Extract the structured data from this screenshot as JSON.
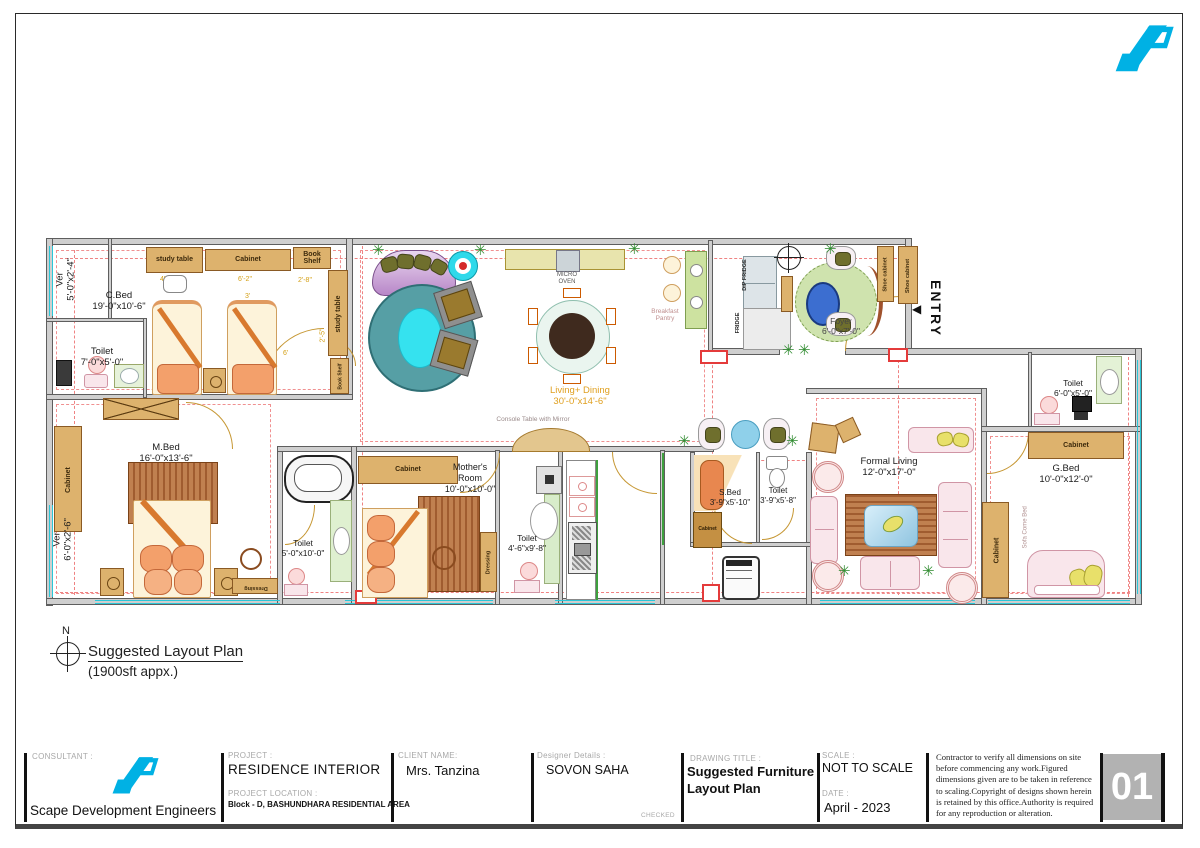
{
  "glyphs": {
    "plant": "✳",
    "arrow_left": "◀",
    "north": "N"
  },
  "entry_label": "ENTRY",
  "plan_title": {
    "title": "Suggested Layout Plan",
    "subtitle": "(1900sft appx.)"
  },
  "rooms": [
    {
      "name": "Ver",
      "dims": "5'-0\"x2'-4\""
    },
    {
      "name": "C.Bed",
      "dims": "19'-0\"x10'-6\""
    },
    {
      "name": "Toilet",
      "dims": "7'-0\"x5'-0\""
    },
    {
      "name": "M.Bed",
      "dims": "16'-0\"x13'-6\""
    },
    {
      "name": "Ver",
      "dims": "6'-0\"x2'-6\""
    },
    {
      "name": "Toilet",
      "dims": "5'-0\"x10'-0\""
    },
    {
      "name": "Mother's Room",
      "dims": "10'-0\"x10'-0\""
    },
    {
      "name": "Toilet",
      "dims": "4'-6\"x9'-8\""
    },
    {
      "name": "Living+ Dining",
      "dims": "30'-0\"x14'-6\""
    },
    {
      "name": "Foyer",
      "dims": "6'-0\"x7'-0\""
    },
    {
      "name": "S.Bed",
      "dims": "3'-9\"x5'-10\""
    },
    {
      "name": "Toilet",
      "dims": "3'-9\"x5'-8\""
    },
    {
      "name": "Formal Living",
      "dims": "12'-0\"x17'-0\""
    },
    {
      "name": "G.Bed",
      "dims": "10'-0\"x12'-0\""
    },
    {
      "name": "Toilet",
      "dims": "6'-0\"x5'-0\""
    }
  ],
  "furniture": {
    "study_table": "study table",
    "cabinet": "Cabinet",
    "book_shelf": "Book Shelf",
    "shoe_cabinet": "Shoe cabinet",
    "dip_fridge": "DIP FRIDGE",
    "fridge": "FRIDGE",
    "micro_oven": "MICRO OVEN",
    "breakfast_pantry": "Breakfast Pantry",
    "console_table": "Console Table with Mirror",
    "dressing": "Dressing",
    "sofa_come_bed": "Sofa Come Bed"
  },
  "dims_cbed": [
    "4'",
    "6'-2\"",
    "2'-8\"",
    "3'",
    "6'",
    "2'-5\""
  ],
  "titleblock": {
    "consultant_label": "CONSULTANT :",
    "consultant_name": "Scape Development Engineers",
    "project_label": "PROJECT :",
    "project_name": "RESIDENCE INTERIOR",
    "location_label": "PROJECT  LOCATION :",
    "location_value": "Block - D, BASHUNDHARA RESIDENTIAL AREA",
    "client_label": "CLIENT NAME:",
    "client_name": "Mrs. Tanzina",
    "designer_label": "Designer Details :",
    "designer_name": "SOVON SAHA",
    "checked_label": "CHECKED",
    "drawing_title_label": "DRAWING TITLE :",
    "drawing_title": "Suggested Furniture Layout Plan",
    "scale_label": "SCALE :",
    "scale_value": "NOT TO SCALE",
    "date_label": "DATE :",
    "date_value": "April -  2023",
    "notes": "Contractor to verify all dimensions on site before commencing any work.Figured dimensions given are to be taken in reference to scaling.Copyright of designs shown herein is retained by this office.Authority is required for any reproduction or alteration.",
    "sheet_number": "01"
  }
}
